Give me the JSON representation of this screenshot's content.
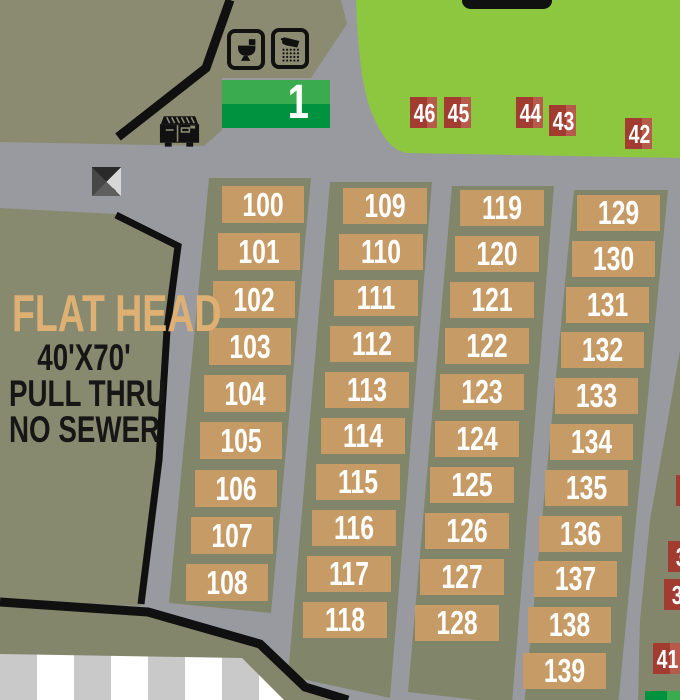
{
  "map": {
    "area_sign": {
      "number": "1"
    },
    "area_info": {
      "title": "FLAT HEAD",
      "dimensions": "40'X70'",
      "access": "PULL THRU",
      "sewer": "NO SEWER"
    },
    "rv_site_columns": [
      {
        "name": "column-1",
        "sites": [
          "100",
          "101",
          "102",
          "103",
          "104",
          "105",
          "106",
          "107",
          "108"
        ]
      },
      {
        "name": "column-2",
        "sites": [
          "109",
          "110",
          "111",
          "112",
          "113",
          "114",
          "115",
          "116",
          "117",
          "118"
        ]
      },
      {
        "name": "column-3",
        "sites": [
          "119",
          "120",
          "121",
          "122",
          "123",
          "124",
          "125",
          "126",
          "127",
          "128"
        ]
      },
      {
        "name": "column-4",
        "sites": [
          "129",
          "130",
          "131",
          "132",
          "133",
          "134",
          "135",
          "136",
          "137",
          "138",
          "139"
        ]
      }
    ],
    "tent_sites_on_lawn": [
      "46",
      "45",
      "44",
      "43",
      "42"
    ],
    "tent_sites_right_edge": [
      "",
      "3",
      "3",
      "41"
    ],
    "icons": {
      "toilet": "toilet-icon",
      "shower": "shower-icon",
      "dumpster": "dumpster-icon",
      "pyramid_marker": "pyramid-marker-icon"
    },
    "colors": {
      "road_gray": "#999aa0",
      "olive_background": "#8a8b71",
      "site_strip_olive": "#81866a",
      "lawn_green": "#8dc63f",
      "rv_site_tan": "#c79b65",
      "site_number_text": "#ffffff",
      "tent_red_dark": "#a23b30",
      "tent_red_light": "#b65a4b",
      "sign_green_top": "#3aab4f",
      "sign_green_bottom": "#00923f",
      "boundary_black": "#101010",
      "building_stripe_gray": "#c9c9c9",
      "building_stripe_white": "#ffffff",
      "area_title_tan": "#dfb074"
    }
  }
}
